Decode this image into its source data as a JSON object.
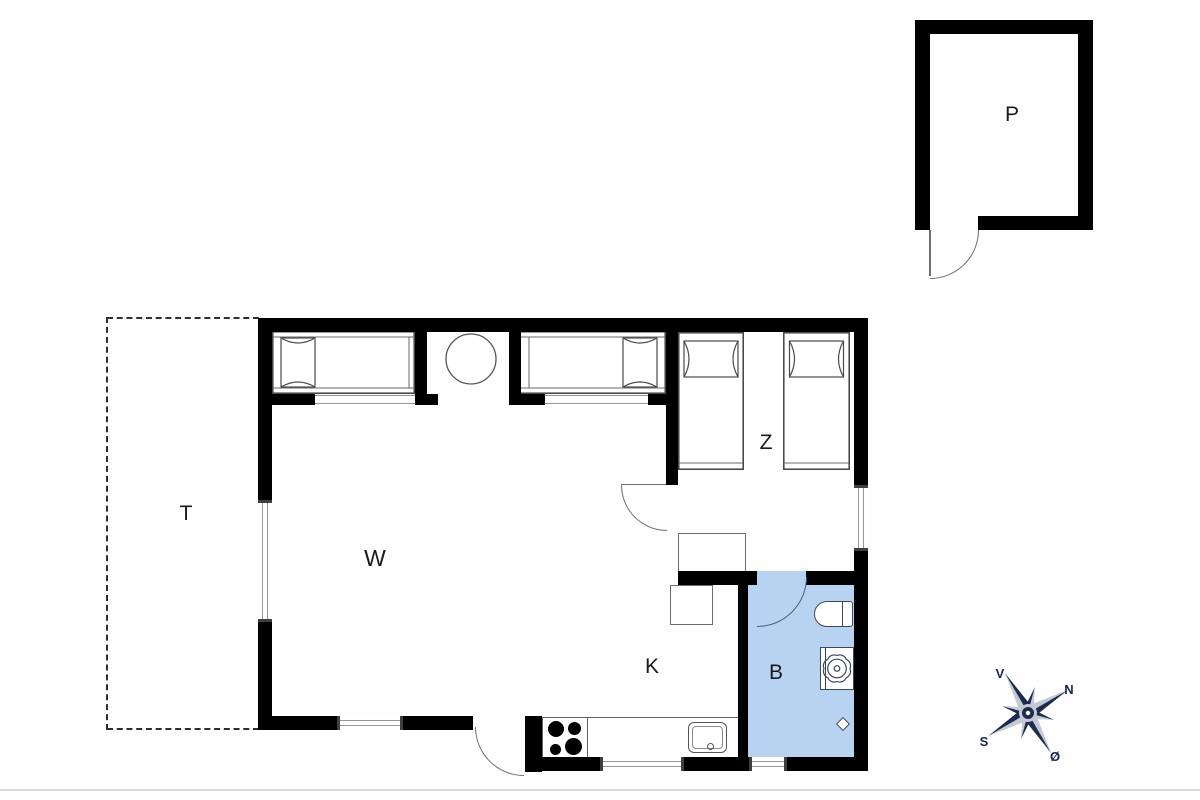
{
  "plan": {
    "rooms": [
      {
        "id": "living-room",
        "label": "W"
      },
      {
        "id": "kitchen",
        "label": "K"
      },
      {
        "id": "bathroom",
        "label": "B"
      },
      {
        "id": "bedroom",
        "label": "Z"
      },
      {
        "id": "terrace",
        "label": "T"
      },
      {
        "id": "outbuilding",
        "label": "P"
      }
    ],
    "compass": {
      "west": "V",
      "north": "N",
      "south": "S",
      "east": "Ø"
    }
  },
  "fixtures": [
    "alcove-double-bed",
    "single-bed",
    "pillow",
    "round-table",
    "kitchen-counter",
    "stove-burners",
    "kitchen-sink",
    "wardrobe",
    "cabinet",
    "toilet",
    "washbasin",
    "floor-drain",
    "door-swing",
    "window",
    "compass-rose"
  ],
  "colors": {
    "wall": "#000000",
    "bath_fill": "#b8d2f2",
    "door_arc": "#6f6f6f",
    "bath_door_arc": "#42608f",
    "fixture_line": "#3f3f3f",
    "bath_fixture_line": "#3d4857",
    "window_line": "#979797",
    "window_cap": "#3f3f3f",
    "label": "#1a1a1a",
    "compass_dark": "#1d2b4e",
    "compass_light": "#c3c9d4",
    "compass_text": "#16264d",
    "baseline": "#dcdcdc",
    "dash_line": "#2e2e2e"
  }
}
